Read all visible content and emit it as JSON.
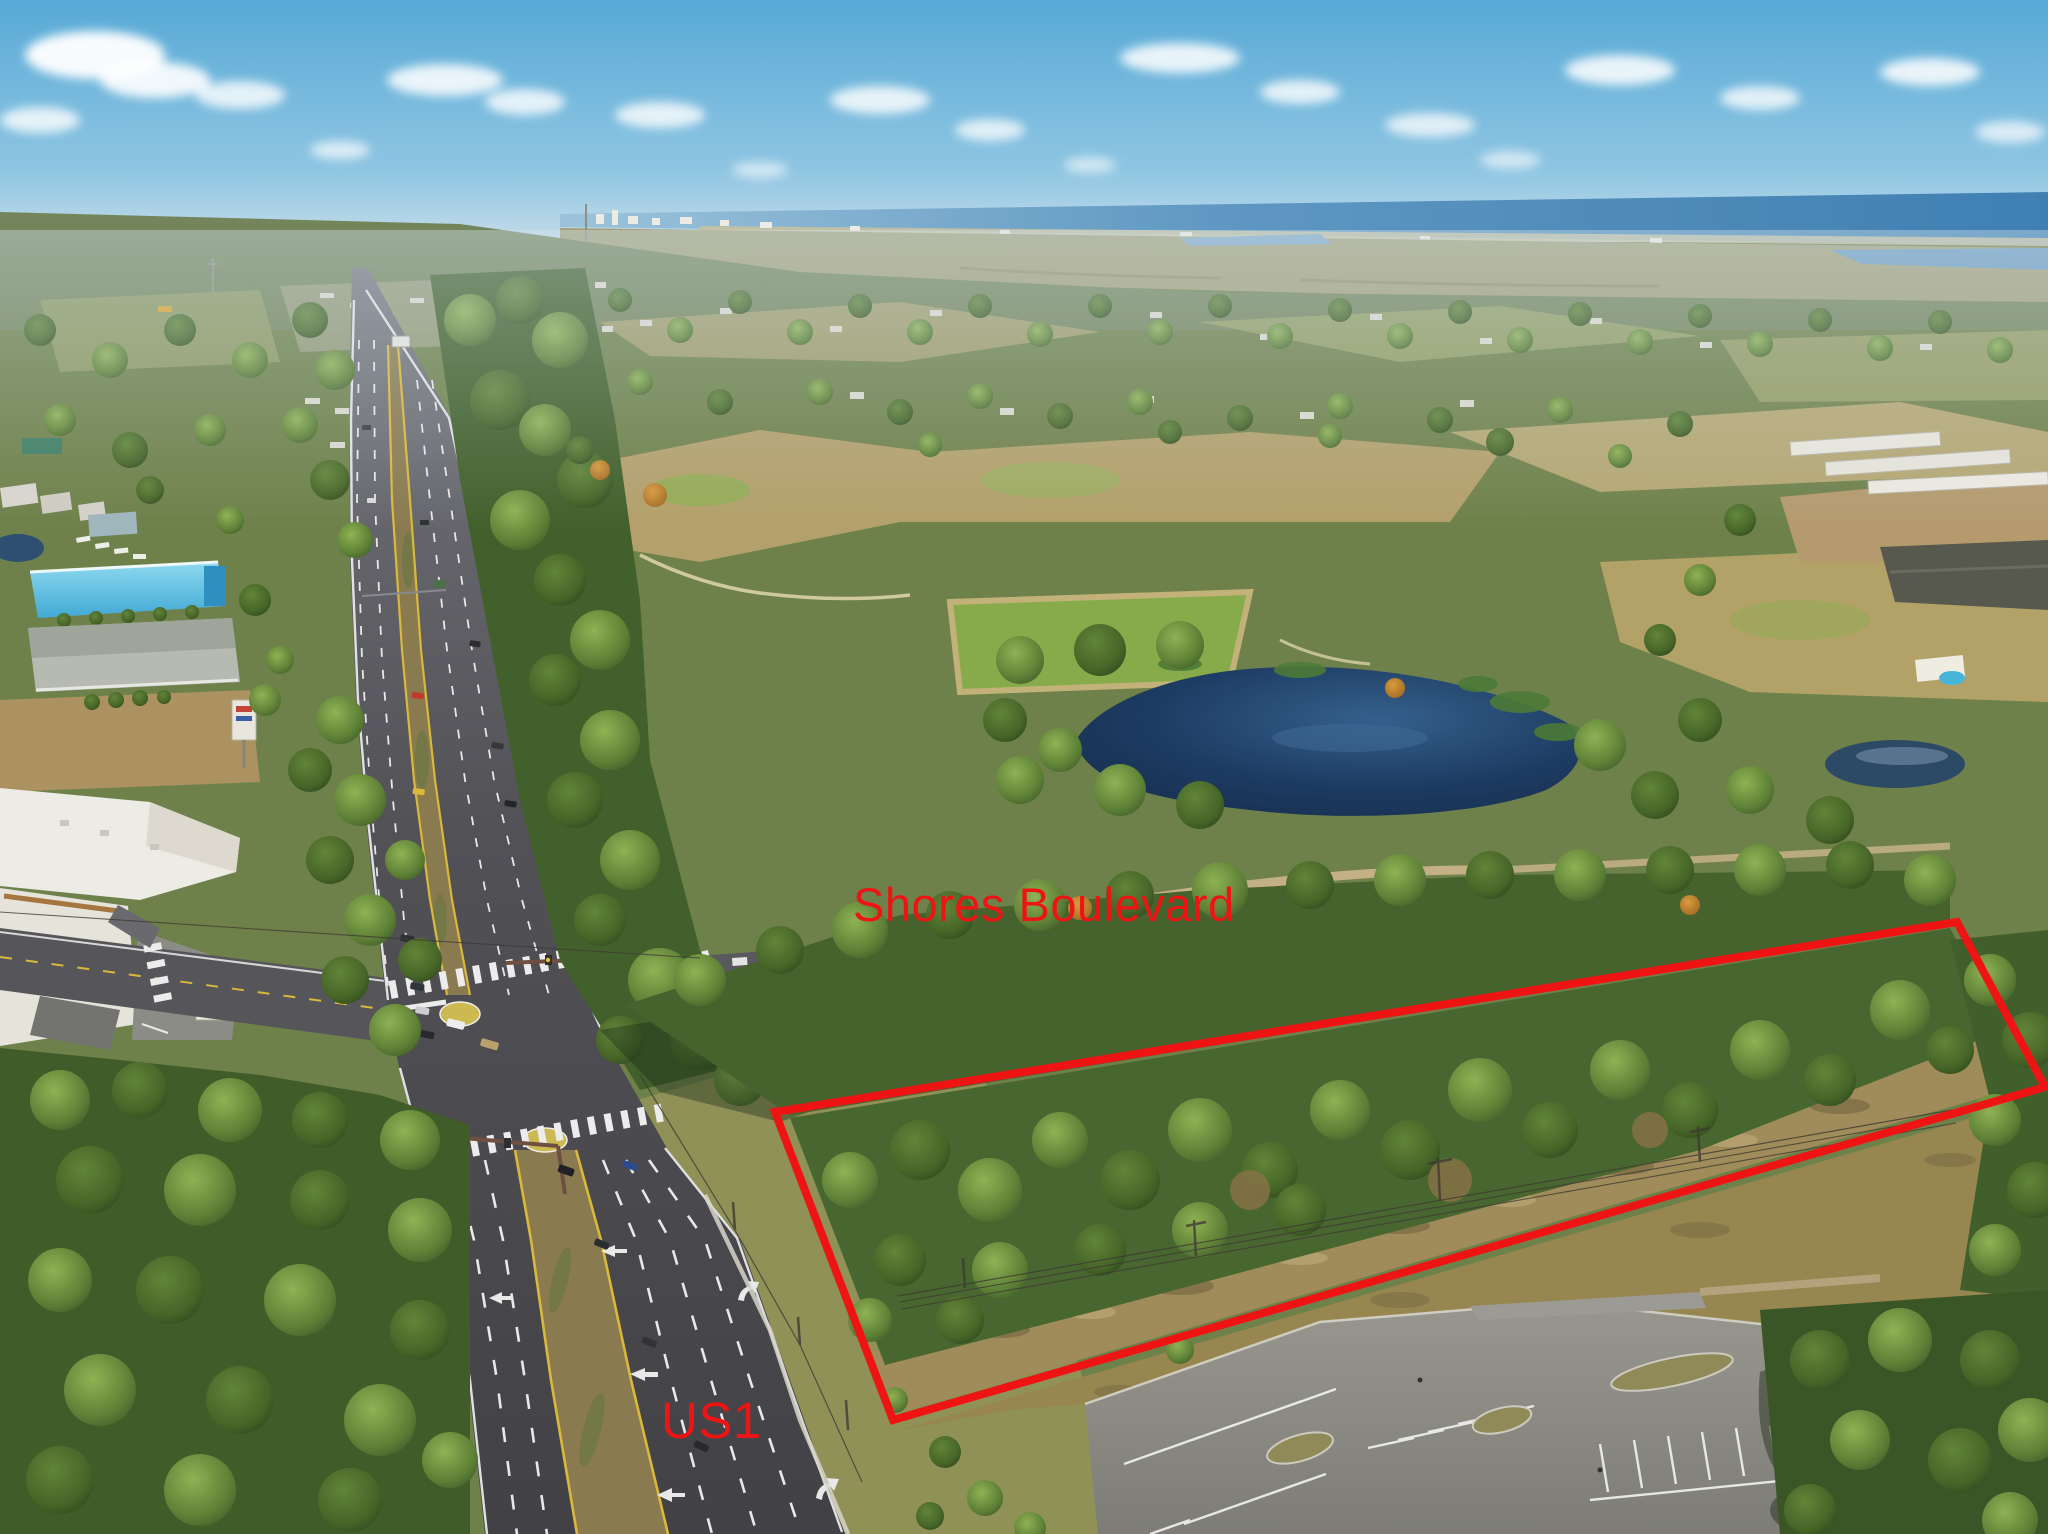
{
  "annotations": {
    "accent_color": "#ee1414",
    "street_label": {
      "text": "Shores Boulevard"
    },
    "highway_label": {
      "text": "US1"
    },
    "parcel_outline": {
      "points": "775,1112 1957,922 2045,1087 893,1420",
      "stroke_width": "8"
    }
  },
  "photo": {
    "colors": {
      "sky": "#57a9d6",
      "ocean": "#3f7fb2",
      "pond": "#1d3c63",
      "asphalt": "#4a4a4e",
      "median_dirt": "#8a7a4f",
      "lane_yellow": "#d9b83c",
      "tree_green": "#4a682c",
      "scrub_tan": "#a08c5a"
    }
  }
}
